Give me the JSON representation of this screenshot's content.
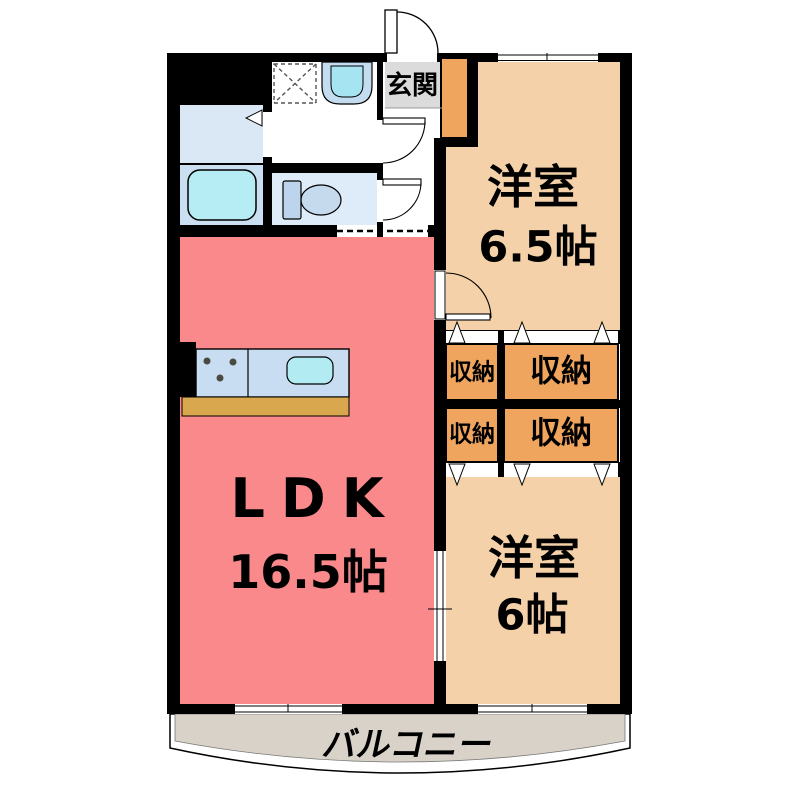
{
  "plan": {
    "entrance": {
      "label": "玄関"
    },
    "bedroom_top": {
      "name": "洋室",
      "size": "6.5帖"
    },
    "bedroom_bottom": {
      "name": "洋室",
      "size": "6帖"
    },
    "ldk": {
      "name": "LDK",
      "size": "16.5帖"
    },
    "balcony": {
      "label": "バルコニー"
    },
    "storages": [
      {
        "label": "収納"
      },
      {
        "label": "収納"
      },
      {
        "label": "収納"
      },
      {
        "label": "収納"
      }
    ]
  },
  "colors": {
    "wall": "#000000",
    "ldk": "#F9898B",
    "bedroom": "#F4D1A8",
    "storage": "#F0A55F",
    "shoebox": "#F0A55F",
    "genkan": "#DBDBDB",
    "balcony": "#D8D2C9",
    "powder_room": "#DAE8F6",
    "bath_room": "#CBDFF2",
    "toilet_room": "#DEEBF8",
    "bathtub": "#B6ECF4",
    "kitchen_counter": "#C9DDF2",
    "kitchen_sink": "#B3EBF3",
    "counter_edge": "#D9A84E",
    "basin_outer": "#C4DCF0",
    "basin_inner": "#A6E4F2",
    "toilet_fixture": "#C6DAEE"
  }
}
